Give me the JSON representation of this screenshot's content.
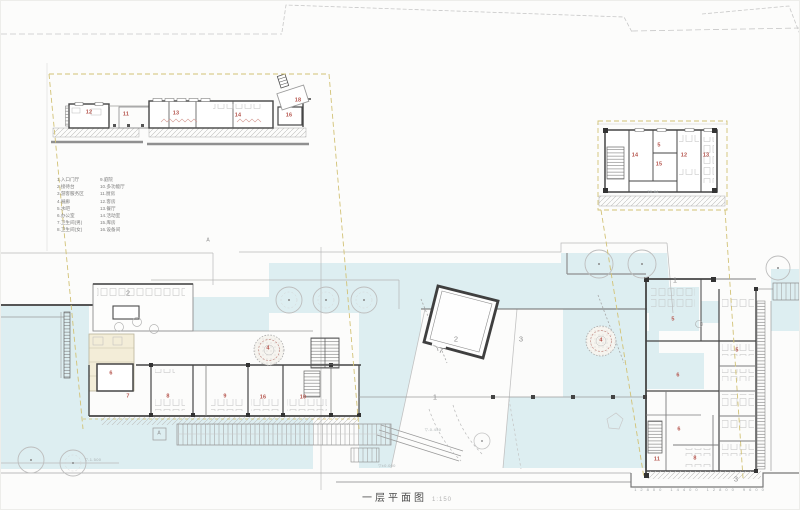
{
  "title": {
    "text": "一层平面图",
    "scale": "1:150"
  },
  "legend": {
    "col1": [
      "1.入口门厅",
      "2.接待台",
      "3.游客服务区",
      "4.展廊",
      "5.水吧",
      "6.办公室",
      "7.卫生间(男)",
      "8.卫生间(女)"
    ],
    "col2": [
      "9.庭院",
      "10.多功能厅",
      "11.厨房",
      "12.客房",
      "13.餐厅",
      "14.活动室",
      "15.库房",
      "16.设备间"
    ]
  },
  "rooms": {
    "dl": [
      "12",
      "11",
      "13",
      "14",
      "16",
      "18"
    ],
    "dr": [
      "14",
      "5",
      "15",
      "12",
      "13"
    ],
    "left": [
      "6",
      "7",
      "8",
      "9",
      "16",
      "10"
    ],
    "right": [
      "5",
      "5",
      "6",
      "6",
      "11",
      "8"
    ],
    "areas": [
      "1",
      "2",
      "3",
      "4",
      "4",
      "1",
      "3",
      "2"
    ]
  },
  "markers": {
    "a1": "A",
    "a2": "A"
  },
  "annotations": {
    "elev1": "▽-1.500",
    "elev2": "▽±0.000",
    "elev3": "▽-0.450",
    "detail_dim": "70.84",
    "dims_bottom": "12800 14400 12800 9600"
  },
  "colors": {
    "water": "#ddeef1",
    "boundary_yellow": "#d2c276",
    "accent_red": "#b5544c"
  }
}
